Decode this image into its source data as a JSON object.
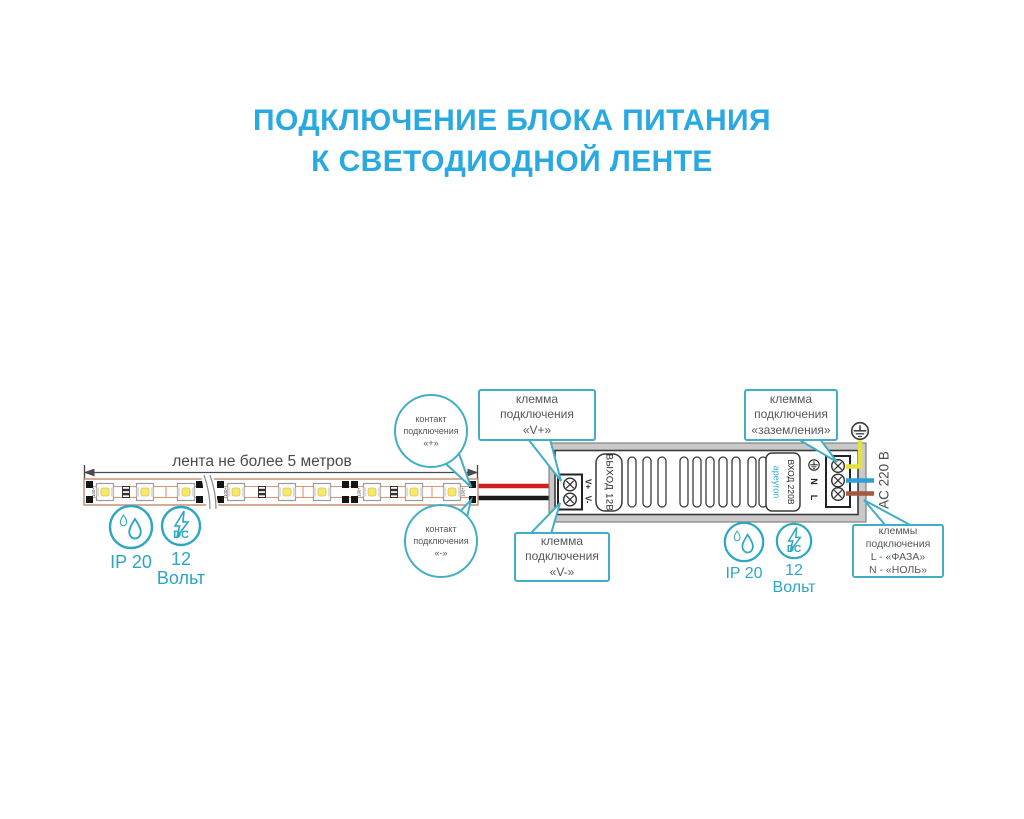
{
  "title": {
    "text": "ПОДКЛЮЧЕНИЕ БЛОКА ПИТАНИЯ\nК СВЕТОДИОДНОЙ ЛЕНТЕ"
  },
  "colors": {
    "accent_blue": "#29a9e1",
    "callout_teal": "#41aec6",
    "icon_teal": "#2ba6c3",
    "wire_red": "#d01f1f",
    "wire_black": "#1a1a1a",
    "wire_yellow": "#e6e23c",
    "wire_blue": "#2d9fd8",
    "wire_brown": "#a2593c"
  },
  "strip": {
    "dimension_label": "лента не более 5 метров",
    "pad_marking": "100+"
  },
  "psu": {
    "output_label": "ВЫХОД 12В",
    "brand": "apeyron",
    "input_label": "ВХОД 220В",
    "terminal_vplus": "V+",
    "terminal_vminus": "V-",
    "terminal_n": "N",
    "terminal_l": "L",
    "ac_label": "AC 220 В"
  },
  "callouts": {
    "contact_plus": "контакт\nподключения\n«+»",
    "contact_minus": "контакт\nподключения\n«-»",
    "terminal_vplus": "клемма\nподключения\n«V+»",
    "terminal_vminus": "клемма\nподключения\n«V-»",
    "terminal_ground": "клемма\nподключения\n«заземления»",
    "terminal_mains": "клеммы\nподключения\nL - «ФАЗА»\nN - «НОЛЬ»"
  },
  "badges": {
    "ip_label": "IP 20",
    "voltage_value": "12",
    "voltage_unit": "Вольт",
    "dc_text": "DC"
  }
}
